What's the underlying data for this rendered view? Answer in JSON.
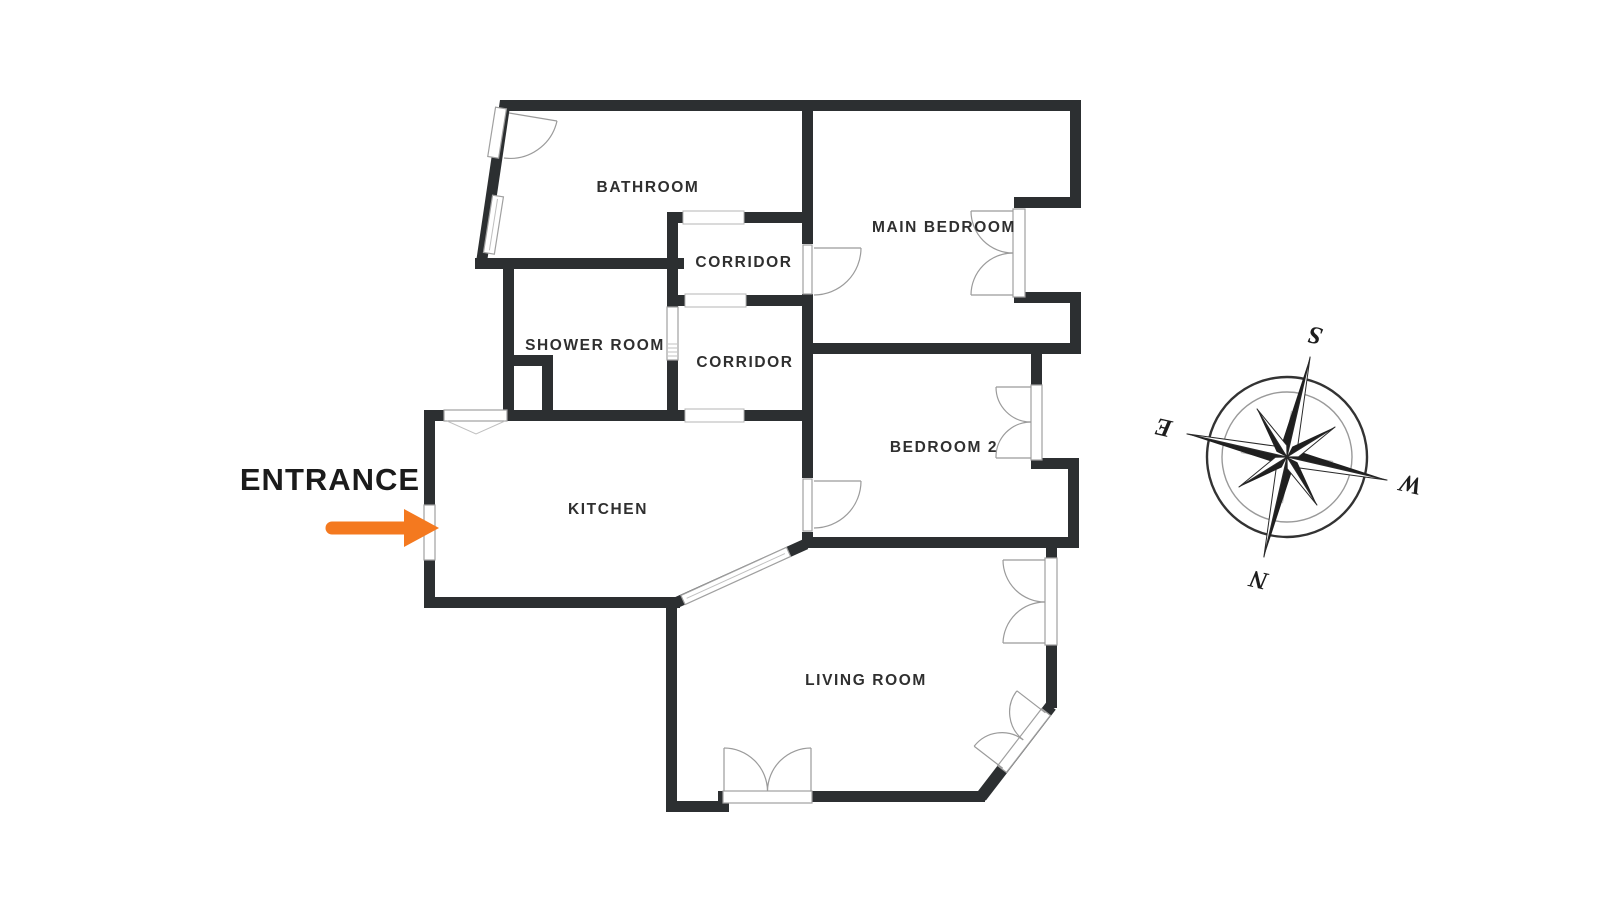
{
  "floor_plan": {
    "rooms": [
      {
        "id": "bathroom",
        "label": "BATHROOM"
      },
      {
        "id": "corridor-upper",
        "label": "CORRIDOR"
      },
      {
        "id": "main-bedroom",
        "label": "MAIN BEDROOM"
      },
      {
        "id": "shower-room",
        "label": "SHOWER ROOM"
      },
      {
        "id": "corridor-lower",
        "label": "CORRIDOR"
      },
      {
        "id": "bedroom-2",
        "label": "BEDROOM 2"
      },
      {
        "id": "kitchen",
        "label": "KITCHEN"
      },
      {
        "id": "living-room",
        "label": "LIVING ROOM"
      }
    ],
    "entrance": {
      "label": "ENTRANCE",
      "arrow_color": "#F4791F"
    },
    "compass": {
      "south": "S",
      "north": "N",
      "east": "E",
      "west": "W",
      "rotation_deg": 193
    },
    "colors": {
      "wall": "#2c2f31",
      "window_frame": "#a0a0a0",
      "door_arc": "#9b9b9b",
      "arrow_orange": "#F4791F",
      "label_text": "#2f2f2f",
      "background": "#ffffff"
    }
  }
}
